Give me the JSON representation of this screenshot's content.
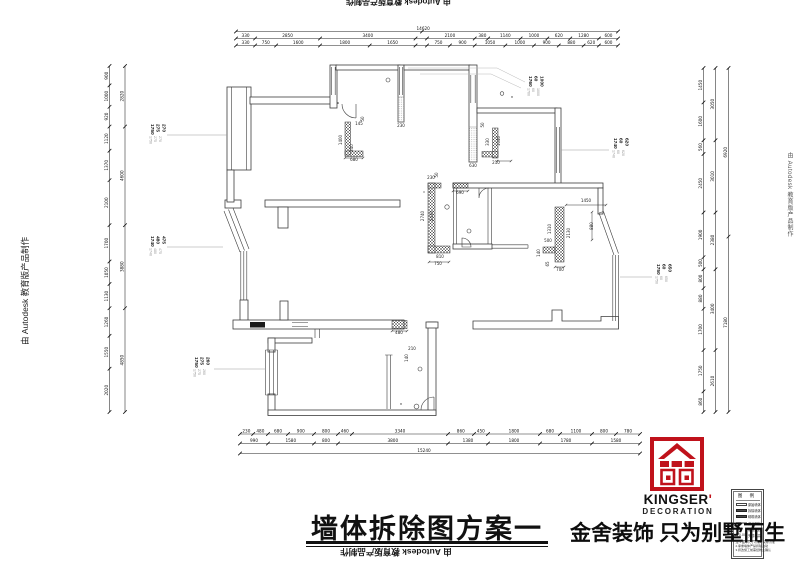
{
  "watermark": {
    "text": "由 Autodesk 教育版产品制作"
  },
  "title": {
    "text": "墙体拆除图方案一"
  },
  "brand": {
    "name": "KINGSER",
    "apostrophe": "'",
    "sub": "DECORATION",
    "slogan": "金舍装饰 只为别墅而生",
    "red": "#c0121b"
  },
  "legend": {
    "header": "图  例",
    "rows": [
      {
        "type": "outline",
        "label": "原始墙体"
      },
      {
        "type": "filled",
        "label": "拆除墙体"
      },
      {
        "type": "filled",
        "label": "砌筑墙体"
      },
      {
        "type": "thin",
        "label": "成品隔断"
      },
      {
        "type": "circle",
        "label": "烟道风道"
      },
      {
        "type": "mark",
        "label": "完成标高"
      }
    ],
    "notes": [
      "注:1.图中尺寸以现场实际为准",
      "2.承重墙体严禁拆除改动",
      "3.拆改施工前需经物业确认"
    ]
  },
  "leaders": [
    {
      "x": 148,
      "y": 124,
      "vals": [
        "1750",
        "275",
        "270"
      ],
      "line": [
        167,
        135,
        227,
        135
      ]
    },
    {
      "x": 148,
      "y": 236,
      "vals": [
        "1740",
        "480",
        "475"
      ],
      "line": [
        167,
        247,
        223,
        247
      ]
    },
    {
      "x": 526,
      "y": 76,
      "vals": [
        "1760",
        "60",
        "1000"
      ],
      "line": null
    },
    {
      "x": 611,
      "y": 138,
      "vals": [
        "1740",
        "60",
        "620"
      ],
      "line": [
        561,
        150,
        609,
        150
      ]
    },
    {
      "x": 654,
      "y": 264,
      "vals": [
        "1750",
        "60",
        "650"
      ],
      "line": [
        620,
        277,
        652,
        277
      ]
    },
    {
      "x": 192,
      "y": 357,
      "vals": [
        "1750",
        "275",
        "260"
      ],
      "line": [
        214,
        369,
        266,
        369
      ]
    }
  ],
  "chains": [
    {
      "o": "h",
      "x": 236,
      "y": 31.5,
      "len": 382,
      "ticks": [
        0,
        0.487,
        1
      ],
      "labels": [
        [
          "14620",
          0.49
        ]
      ]
    },
    {
      "o": "h",
      "x": 236,
      "y": 38.5,
      "len": 382,
      "ticks": [
        0,
        0.05,
        0.22,
        0.47,
        0.5,
        0.625,
        0.66,
        0.745,
        0.815,
        0.875,
        0.95,
        1
      ],
      "labels": [
        [
          "330",
          0.025
        ],
        [
          "2850",
          0.135
        ],
        [
          "3400",
          0.345
        ],
        [
          "2100",
          0.56
        ],
        [
          "380",
          0.645
        ],
        [
          "1140",
          0.705
        ],
        [
          "1000",
          0.78
        ],
        [
          "620",
          0.845
        ],
        [
          "1280",
          0.91
        ],
        [
          "600",
          0.975
        ]
      ]
    },
    {
      "o": "h",
      "x": 236,
      "y": 45.5,
      "len": 382,
      "ticks": [
        0,
        0.05,
        0.105,
        0.22,
        0.35,
        0.47,
        0.5,
        0.56,
        0.625,
        0.705,
        0.78,
        0.845,
        0.91,
        0.95,
        1
      ],
      "labels": [
        [
          "330",
          0.025
        ],
        [
          "750",
          0.078
        ],
        [
          "1600",
          0.163
        ],
        [
          "1800",
          0.285
        ],
        [
          "1650",
          0.41
        ],
        [
          "750",
          0.53
        ],
        [
          "900",
          0.593
        ],
        [
          "1050",
          0.665
        ],
        [
          "1000",
          0.743
        ],
        [
          "900",
          0.813
        ],
        [
          "880",
          0.878
        ],
        [
          "620",
          0.93
        ],
        [
          "600",
          0.975
        ]
      ]
    },
    {
      "o": "h",
      "x": 240,
      "y": 434,
      "len": 400,
      "ticks": [
        0,
        0.033,
        0.07,
        0.12,
        0.185,
        0.245,
        0.28,
        0.52,
        0.585,
        0.62,
        0.75,
        0.8,
        0.88,
        0.94,
        1
      ],
      "labels": [
        [
          "230",
          0.016
        ],
        [
          "480",
          0.051
        ],
        [
          "680",
          0.095
        ],
        [
          "900",
          0.152
        ],
        [
          "800",
          0.215
        ],
        [
          "460",
          0.262
        ],
        [
          "3340",
          0.4
        ],
        [
          "860",
          0.552
        ],
        [
          "450",
          0.602
        ],
        [
          "1800",
          0.685
        ],
        [
          "680",
          0.775
        ],
        [
          "1100",
          0.84
        ],
        [
          "800",
          0.91
        ],
        [
          "780",
          0.97
        ]
      ]
    },
    {
      "o": "h",
      "x": 240,
      "y": 443.5,
      "len": 400,
      "ticks": [
        0,
        0.07,
        0.185,
        0.245,
        0.52,
        0.62,
        0.75,
        0.88,
        1
      ],
      "labels": [
        [
          "990",
          0.035
        ],
        [
          "1580",
          0.127
        ],
        [
          "800",
          0.215
        ],
        [
          "3800",
          0.382
        ],
        [
          "1380",
          0.57
        ],
        [
          "1800",
          0.685
        ],
        [
          "1780",
          0.815
        ],
        [
          "1580",
          0.94
        ]
      ]
    },
    {
      "o": "h",
      "x": 240,
      "y": 453.5,
      "len": 400,
      "ticks": [
        0,
        1
      ],
      "labels": [
        [
          "15240",
          0.46
        ]
      ]
    },
    {
      "o": "v",
      "x": 109.5,
      "y": 66,
      "len": 346,
      "ticks": [
        0,
        0.056,
        0.118,
        0.175,
        0.245,
        0.33,
        0.46,
        0.565,
        0.63,
        0.7,
        0.78,
        0.875,
        1
      ],
      "labels": [
        [
          "900",
          0.028
        ],
        [
          "1000",
          0.087
        ],
        [
          "920",
          0.146
        ],
        [
          "1120",
          0.21
        ],
        [
          "1370",
          0.287
        ],
        [
          "2100",
          0.395
        ],
        [
          "1700",
          0.512
        ],
        [
          "1050",
          0.597
        ],
        [
          "1130",
          0.665
        ],
        [
          "1260",
          0.74
        ],
        [
          "1550",
          0.827
        ],
        [
          "2020",
          0.937
        ]
      ]
    },
    {
      "o": "v",
      "x": 125,
      "y": 66,
      "len": 346,
      "ticks": [
        0,
        0.175,
        0.46,
        0.7,
        1
      ],
      "labels": [
        [
          "2820",
          0.087
        ],
        [
          "4600",
          0.317
        ],
        [
          "3880",
          0.58
        ],
        [
          "4850",
          0.85
        ]
      ]
    },
    {
      "o": "v",
      "x": 703.5,
      "y": 68,
      "len": 344,
      "ticks": [
        0,
        0.1,
        0.21,
        0.25,
        0.42,
        0.55,
        0.585,
        0.64,
        0.7,
        0.82,
        0.94,
        1
      ],
      "labels": [
        [
          "1450",
          0.05
        ],
        [
          "1600",
          0.155
        ],
        [
          "560",
          0.23
        ],
        [
          "2450",
          0.335
        ],
        [
          "1900",
          0.485
        ],
        [
          "500",
          0.567
        ],
        [
          "800",
          0.612
        ],
        [
          "880",
          0.67
        ],
        [
          "1700",
          0.76
        ],
        [
          "1750",
          0.88
        ],
        [
          "860",
          0.97
        ]
      ]
    },
    {
      "o": "v",
      "x": 715.5,
      "y": 68,
      "len": 344,
      "ticks": [
        0,
        0.21,
        0.42,
        0.585,
        0.82,
        1
      ],
      "labels": [
        [
          "3050",
          0.105
        ],
        [
          "3010",
          0.315
        ],
        [
          "2380",
          0.5
        ],
        [
          "3400",
          0.7
        ],
        [
          "2610",
          0.91
        ]
      ]
    },
    {
      "o": "v",
      "x": 728.5,
      "y": 68,
      "len": 344,
      "ticks": [
        0,
        0.49,
        1
      ],
      "labels": [
        [
          "6920",
          0.245
        ],
        [
          "7180",
          0.74
        ]
      ]
    }
  ],
  "plan_dims": [
    [
      "1400",
      342,
      140,
      1
    ],
    [
      "340",
      353,
      148,
      1
    ],
    [
      "680",
      354,
      161,
      0
    ],
    [
      "145",
      359,
      125,
      0
    ],
    [
      "50",
      364,
      119,
      1
    ],
    [
      "1040",
      500,
      141,
      1
    ],
    [
      "330",
      489,
      142,
      1
    ],
    [
      "210",
      496,
      164,
      0
    ],
    [
      "50",
      484,
      125,
      1
    ],
    [
      "630",
      473,
      167,
      0
    ],
    [
      "230",
      401,
      127,
      0
    ],
    [
      "690",
      460,
      194,
      0
    ],
    [
      "2740",
      424,
      216,
      1
    ],
    [
      "2430",
      433,
      216,
      1
    ],
    [
      "810",
      440,
      258,
      0
    ],
    [
      "750",
      438,
      265,
      0
    ],
    [
      "230",
      431,
      179,
      0
    ],
    [
      "50",
      438,
      175,
      1
    ],
    [
      "1310",
      551,
      229,
      1
    ],
    [
      "500",
      548,
      242,
      0
    ],
    [
      "2130",
      570,
      233,
      1
    ],
    [
      "1450",
      586,
      202,
      0
    ],
    [
      "880",
      593,
      226,
      1
    ],
    [
      "140",
      540,
      253,
      1
    ],
    [
      "700",
      560,
      271,
      0
    ],
    [
      "65",
      549,
      264,
      1
    ],
    [
      "480",
      399,
      334,
      0
    ],
    [
      "210",
      412,
      350,
      0
    ],
    [
      "140",
      408,
      358,
      1
    ]
  ]
}
